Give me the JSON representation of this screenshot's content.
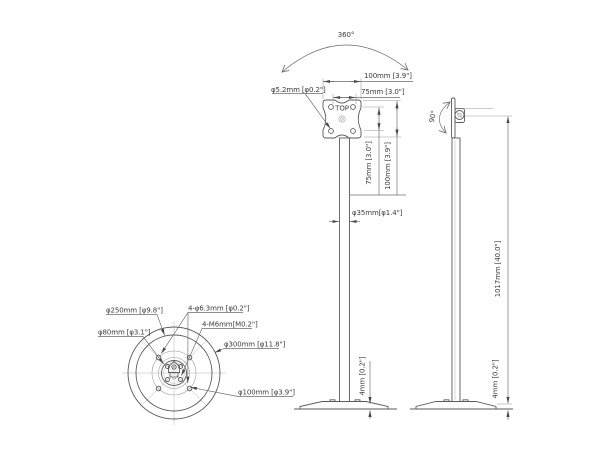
{
  "labels": {
    "rotation_arc": "360°",
    "tilt_arc": "90°",
    "plate_marking": "TOP",
    "front": {
      "mount_hole_dia": "φ5.2mm [φ0.2\"]",
      "plate_width": "100mm [3.9\"]",
      "hole_spacing_h": "75mm [3.0\"]",
      "hole_spacing_v": "75mm [3.0\"]",
      "plate_height": "100mm [3.9\"]",
      "pole_dia": "φ35mm[φ1.4\"]",
      "base_edge_thickness": "4mm [0.2\"]"
    },
    "side": {
      "pole_height": "1017mm [40.0\"]",
      "base_edge_thickness": "4mm [0.2\"]"
    },
    "base_view": {
      "inner_plate_dia": "φ250mm [φ9.8\"]",
      "through_holes": "4-φ6.3mm [φ0.2\"]",
      "thread_holes": "4-M6mm[M0.2\"]",
      "hub_dia": "φ80mm [φ3.1\"]",
      "base_dia": "φ300mm [φ11.8\"]",
      "circle_100_dia": "φ100mm [φ3.9\"]"
    }
  }
}
